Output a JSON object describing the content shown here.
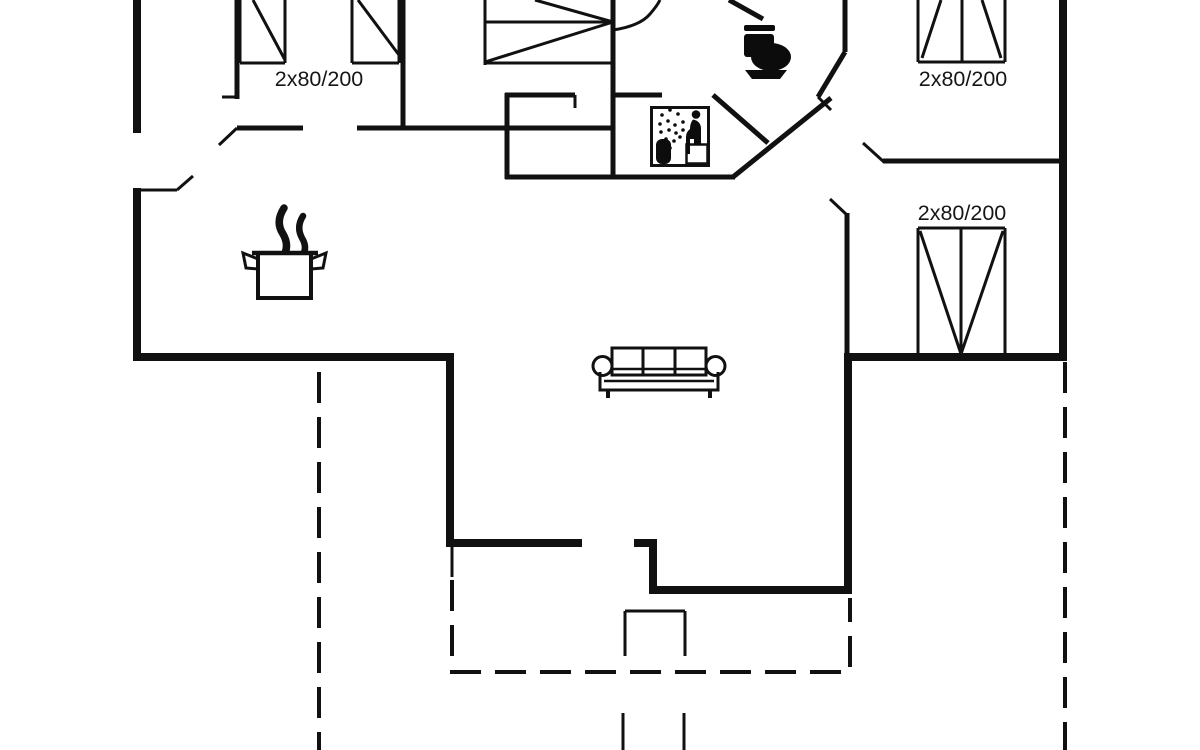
{
  "page": {
    "type": "floor-plan-drawing",
    "background": "#ffffff",
    "line_color": "#111111",
    "steam_color": "#bdbdbd",
    "text_color": "#161616"
  },
  "labels": [
    {
      "id": "bed-size-top-left",
      "text": "2x80/200"
    },
    {
      "id": "bed-size-top-right",
      "text": "2x80/200"
    },
    {
      "id": "bed-size-mid-right",
      "text": "2x80/200"
    }
  ],
  "icons": [
    {
      "name": "staircase",
      "meaning": "winder stairs to other floor"
    },
    {
      "name": "toilet-icon",
      "meaning": "toilet in bathroom"
    },
    {
      "name": "shower-sauna-icon",
      "meaning": "shower / sauna pictogram"
    },
    {
      "name": "cooking-pot-icon",
      "meaning": "kitchen (steaming pot)"
    },
    {
      "name": "sofa-icon",
      "meaning": "living room sofa"
    }
  ],
  "plan": {
    "width": 1200,
    "height": 750,
    "stroke": {
      "thick": 8,
      "medium": 5,
      "thin": 3,
      "dashed": 4
    },
    "dash_pattern": "31 14",
    "walls_thick": [
      [
        137,
        0,
        137,
        133
      ],
      [
        137,
        188,
        137,
        361
      ],
      [
        133,
        357,
        454,
        357
      ],
      [
        450,
        353,
        450,
        547
      ],
      [
        446,
        543,
        582,
        543
      ],
      [
        634,
        543,
        657,
        543
      ],
      [
        653,
        539,
        653,
        594
      ],
      [
        649,
        590,
        852,
        590
      ],
      [
        848,
        353,
        848,
        594
      ],
      [
        844,
        357,
        1067,
        357
      ],
      [
        1063,
        0,
        1063,
        361
      ]
    ],
    "walls_medium": [
      [
        237,
        0,
        237,
        99
      ],
      [
        403,
        0,
        403,
        130
      ],
      [
        237,
        128,
        303,
        128
      ],
      [
        357,
        128,
        614,
        128
      ],
      [
        613,
        0,
        613,
        179
      ],
      [
        505,
        95,
        575,
        95
      ],
      [
        507,
        93,
        507,
        179
      ],
      [
        505,
        177,
        735,
        177
      ],
      [
        613,
        95,
        662,
        95
      ],
      [
        713,
        95,
        768,
        143
      ],
      [
        733,
        177,
        831,
        98
      ],
      [
        729,
        0,
        763,
        19
      ],
      [
        845,
        0,
        845,
        52
      ],
      [
        845,
        52,
        818,
        97
      ],
      [
        847,
        213,
        847,
        357
      ],
      [
        883,
        161,
        1063,
        161
      ]
    ],
    "walls_thin": [
      [
        222,
        97,
        237,
        97
      ],
      [
        237,
        128,
        219,
        145
      ],
      [
        137,
        190,
        177,
        190
      ],
      [
        177,
        190,
        193,
        176
      ],
      [
        575,
        95,
        575,
        108
      ],
      [
        818,
        97,
        831,
        110
      ],
      [
        863,
        143,
        884,
        162
      ],
      [
        830,
        199,
        847,
        215
      ],
      [
        452,
        547,
        452,
        577
      ],
      [
        625,
        611,
        685,
        611
      ],
      [
        625,
        611,
        625,
        656
      ],
      [
        685,
        611,
        685,
        656
      ],
      [
        623,
        713,
        623,
        750
      ],
      [
        684,
        713,
        684,
        750
      ]
    ],
    "stairs": [
      [
        485,
        0,
        485,
        65
      ],
      [
        485,
        63,
        615,
        63
      ],
      [
        485,
        22,
        613,
        22
      ],
      [
        485,
        62,
        613,
        22
      ],
      [
        535,
        0,
        613,
        22
      ]
    ],
    "stair_arcs": [
      "M613,30 Q640,26 650,14 Q657,6 660,0"
    ],
    "beds": [
      [
        240,
        0,
        240,
        63
      ],
      [
        285,
        0,
        285,
        63
      ],
      [
        240,
        63,
        285,
        63
      ],
      [
        253,
        0,
        285,
        60
      ],
      [
        352,
        0,
        352,
        63
      ],
      [
        399,
        0,
        399,
        63
      ],
      [
        352,
        63,
        399,
        63
      ],
      [
        358,
        0,
        399,
        55
      ],
      [
        918,
        0,
        918,
        62
      ],
      [
        962,
        0,
        962,
        62
      ],
      [
        1005,
        0,
        1005,
        62
      ],
      [
        918,
        62,
        1005,
        62
      ],
      [
        922,
        58,
        941,
        0
      ],
      [
        1001,
        58,
        982,
        0
      ],
      [
        918,
        228,
        1005,
        228
      ],
      [
        918,
        228,
        918,
        356
      ],
      [
        961,
        228,
        961,
        356
      ],
      [
        1005,
        228,
        1005,
        356
      ],
      [
        920,
        231,
        961,
        354
      ],
      [
        1003,
        231,
        961,
        354
      ]
    ],
    "dashed_paths": [
      "M319,372 V750",
      "M1065,362 V750",
      "M452,580 L452,672 L850,672 L850,598"
    ]
  }
}
